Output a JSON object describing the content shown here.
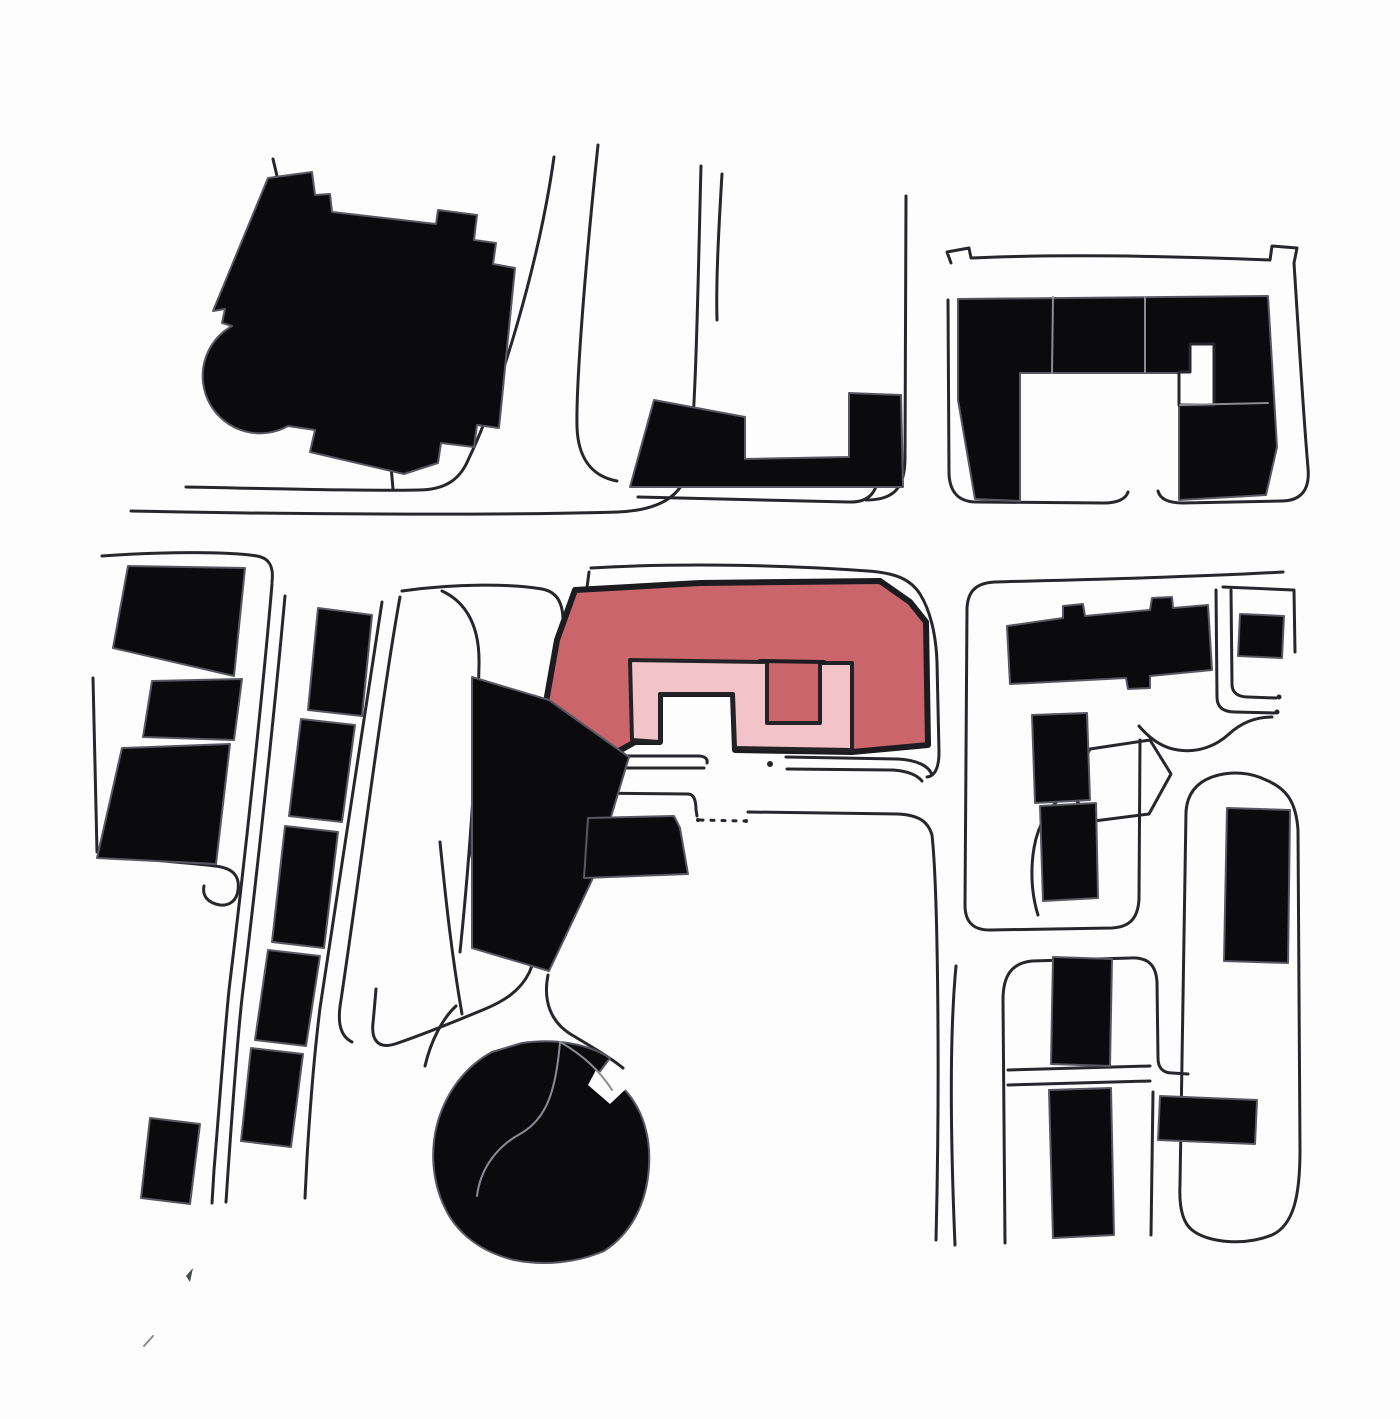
{
  "meta": {
    "description": "Hand-drawn urban figure-ground site plan with black context buildings, sketched street lines and one highlighted U-shaped building filled red with a light pink inner courtyard ring",
    "canvas": {
      "width": 1400,
      "height": 1419,
      "background": "#fdfdfd"
    }
  },
  "colors": {
    "building_fill": "#0b0b0e",
    "building_halo": "#585862",
    "street_line": "#26262c",
    "highlight_red": "#ca656c",
    "highlight_pink": "#f2c3c8",
    "highlight_border": "#1c1c20",
    "faint_line": "#8b8b95",
    "paper": "#fdfdfd"
  },
  "svg": {
    "streets": [
      {
        "name": "street-nw-upper",
        "d": "M 186,487 C 290,489 372,491 418,490 C 447,490 461,478 469,458 C 499,396 539,264 554,157"
      },
      {
        "name": "street-nw-lower",
        "d": "M 131,511 C 320,515 520,515 618,512 C 666,510 684,491 688,468 C 696,428 698,278 701,166"
      },
      {
        "name": "street-center-fork-left",
        "d": "M 598,145 C 585,268 576,384 577,427 C 578,456 590,476 617,481"
      },
      {
        "name": "street-center-fork-right",
        "d": "M 722,174 C 718,240 716,285 717,320"
      },
      {
        "name": "street-center-block-south",
        "d": "M 638,497 L 848,502 C 870,503 879,492 880,464 L 881,433"
      },
      {
        "name": "street-center-block-east",
        "d": "M 906,196 L 905,458 C 905,488 894,500 866,500"
      },
      {
        "name": "street-left-top",
        "d": "M 102,556 C 170,551 232,552 257,556 C 269,558 274,566 272,582"
      },
      {
        "name": "street-left-a",
        "d": "M 272,584 C 263,690 246,850 229,990 C 224,1040 219,1110 214,1170 L 212,1203"
      },
      {
        "name": "street-left-b",
        "d": "M 285,596 C 276,696 259,858 242,998 C 237,1044 232,1114 228,1172 L 226,1202"
      },
      {
        "name": "street-strip-east",
        "d": "M 382,602 C 366,700 340,880 320,1008 C 315,1048 310,1108 307,1158 L 305,1198"
      },
      {
        "name": "street-park-west",
        "d": "M 400,597 C 383,690 359,880 341,1000 C 337,1022 340,1036 352,1042"
      },
      {
        "name": "park-outline",
        "d": "M 402,591 C 458,583 512,584 542,589 C 558,592 564,604 563,627 C 561,690 551,810 546,872 C 542,920 537,956 529,973 C 520,991 504,1001 485,1009 C 449,1024 413,1038 395,1044 C 379,1049 371,1041 373,1023 C 374,1013 375,1001 376,989"
      },
      {
        "name": "park-inner-path",
        "d": "M 442,591 C 466,602 480,626 479,665 C 477,765 467,885 460,952"
      },
      {
        "name": "street-hook-end",
        "d": "M 112,856 C 150,860 190,863 215,866 C 233,868 240,876 238,890 C 237,900 230,906 220,905 C 208,903 202,896 204,886"
      },
      {
        "name": "street-left-edge",
        "d": "M 93,678 L 97,852"
      },
      {
        "name": "site-block-outline-north",
        "d": "M 591,568 C 690,562 800,566 868,571 C 897,573 911,580 920,594 C 930,610 936,634 937,662 L 939,752 C 939,768 935,776 927,777"
      },
      {
        "name": "site-block-outline-west",
        "d": "M 589,572 C 583,615 581,655 584,696"
      },
      {
        "name": "street-site-south-1a",
        "d": "M 612,756 L 698,756 C 705,756 708,759 707,763"
      },
      {
        "name": "street-site-south-1b",
        "d": "M 607,768 L 704,768"
      },
      {
        "name": "street-site-south-2a",
        "d": "M 786,757 L 898,759 C 917,760 929,766 932,775"
      },
      {
        "name": "street-site-south-2b",
        "d": "M 787,769 L 893,770 C 907,771 917,775 922,781"
      },
      {
        "name": "street-lower-block-edge",
        "d": "M 586,793 L 688,794 C 694,794 696,800 696,810 L 697,816"
      },
      {
        "name": "street-mid-east",
        "d": "M 748,812 L 898,814 C 918,815 928,821 932,835 C 938,890 940,1080 936,1240"
      },
      {
        "name": "street-mid-east-2",
        "d": "M 956,966 C 949,1040 951,1150 955,1245"
      },
      {
        "name": "street-sw-1",
        "d": "M 440,842 C 446,902 452,957 462,1014"
      },
      {
        "name": "street-sw-2",
        "d": "M 470,843 C 476,882 481,914 487,942"
      },
      {
        "name": "street-sw-curve",
        "d": "M 548,975 C 543,1000 550,1022 572,1035 C 592,1047 611,1058 623,1068"
      },
      {
        "name": "street-circle-nw",
        "d": "M 456,1006 C 443,1018 431,1040 425,1066"
      },
      {
        "name": "loop-a-outline",
        "d": "M 1283,572 C 1180,578 1060,580 995,582 C 976,583 968,591 967,608 L 965,905 C 965,922 973,930 990,930 L 1112,928 C 1130,927 1138,918 1139,899 L 1140,740"
      },
      {
        "name": "loop-a-east-1",
        "d": "M 1216,590 L 1217,697 C 1217,708 1224,712 1235,712 L 1275,713"
      },
      {
        "name": "loop-a-east-2",
        "d": "M 1231,590 L 1232,684 C 1232,693 1238,697 1248,697 L 1276,698"
      },
      {
        "name": "street-square-top",
        "d": "M 1223,587 C 1247,588 1270,589 1293,590"
      },
      {
        "name": "street-square-right",
        "d": "M 1294,590 L 1295,652"
      },
      {
        "name": "street-zigzag",
        "d": "M 1139,726 C 1150,739 1163,748 1178,750 C 1198,753 1216,746 1229,734 C 1241,723 1256,717 1272,717"
      },
      {
        "name": "island-outline",
        "d": "M 1068,791 L 1090,749 L 1150,740 L 1171,774 L 1149,814 L 1094,821 Z"
      },
      {
        "name": "island-tail",
        "d": "M 1068,793 C 1050,804 1038,824 1034,848 C 1030,872 1032,896 1038,915"
      },
      {
        "name": "loop-b-outline",
        "d": "M 1266,780 C 1285,788 1296,800 1298,830 L 1300,1150 C 1300,1195 1294,1225 1272,1235 C 1245,1246 1208,1243 1192,1230 C 1182,1222 1179,1206 1180,1185 L 1186,812 C 1187,794 1196,783 1212,777 C 1232,770 1252,773 1266,780"
      },
      {
        "name": "loop-c-outline",
        "d": "M 1005,1243 L 1003,1000 C 1003,975 1012,963 1032,961 L 1130,958 C 1148,957 1156,965 1157,982 L 1158,1058 C 1158,1068 1163,1073 1172,1073 L 1188,1074"
      },
      {
        "name": "loop-c-east-lower",
        "d": "M 1153,1092 L 1151,1235"
      },
      {
        "name": "loop-c-cross-1",
        "d": "M 1008,1070 L 1150,1066"
      },
      {
        "name": "loop-c-cross-2",
        "d": "M 1008,1085 L 1150,1081"
      },
      {
        "name": "ne-block-outline-1",
        "d": "M 951,263 L 947,252 L 969,248 L 971,258 C 1060,254 1170,256 1270,260 L 1272,246 L 1297,248 L 1294,263 C 1299,340 1303,410 1308,468 C 1310,490 1301,501 1281,501 L 1183,503 C 1168,503 1160,499 1158,491"
      },
      {
        "name": "ne-block-outline-2",
        "d": "M 1128,492 C 1126,499 1117,503 1104,503 L 977,502 C 959,502 950,493 949,474 L 948,300"
      },
      {
        "name": "nw-tick",
        "d": "M 277,176 L 273,159"
      },
      {
        "name": "nw-connector",
        "d": "M 391,466 L 393,489"
      }
    ],
    "highlight": {
      "outer_name": "highlighted-building-red",
      "outer_d": "M 575,590 L 700,583 L 880,581 L 910,602 L 926,622 L 928,745 L 852,752 L 735,750 L 733,694 L 660,694 L 660,742 L 635,742 L 610,756 L 546,702 L 557,640 Z",
      "inner_name": "highlighted-courtyard-pink",
      "inner_d": "M 630,660 L 767,662 L 767,723 L 820,723 L 820,663 L 852,663 L 852,750 L 735,748 L 733,694 L 660,694 L 660,742 L 632,740 Z",
      "seam_name": "highlight-inner-seam",
      "seam_d": "M 760,661 L 824,662"
    },
    "buildings": [
      {
        "name": "building-nw-large",
        "d": "M 268,178 L 312,172 L 315,195 L 330,194 L 332,212 L 436,224 L 438,210 L 477,215 L 474,240 L 496,243 L 493,264 L 515,268 L 499,428 L 477,425 L 474,447 L 441,443 L 438,463 L 404,474 L 310,452 L 315,430 L 288,426 A 55 55 0 1 1 232,326 L 222,323 L 225,309 L 213,311 Z"
      },
      {
        "name": "building-center-l",
        "d": "M 630,487 L 654,400 L 745,417 L 745,459 L 849,457 L 849,393 L 901,395 L 903,487 Z"
      },
      {
        "name": "building-ne-perimeter",
        "d": "M 958,299 L 1268,296 L 1277,447 L 1266,495 L 1179,500 L 1179,373 L 1020,373 L 1020,501 L 975,499 L 958,400 Z"
      },
      {
        "name": "building-sw-diagonal",
        "d": "M 472,677 L 549,700 L 629,757 L 592,880 L 549,971 L 472,948 Z"
      },
      {
        "name": "building-below-site",
        "d": "M 588,818 L 674,816 L 680,828 L 688,874 L 584,878 Z"
      },
      {
        "name": "building-strip-1",
        "d": "M 318,608 L 372,615 L 362,716 L 308,710 Z"
      },
      {
        "name": "building-strip-2",
        "d": "M 301,719 L 355,725 L 342,822 L 289,816 Z"
      },
      {
        "name": "building-strip-3",
        "d": "M 285,826 L 338,832 L 324,948 L 272,942 Z"
      },
      {
        "name": "building-strip-4",
        "d": "M 268,950 L 320,956 L 306,1046 L 255,1040 Z"
      },
      {
        "name": "building-strip-5",
        "d": "M 251,1048 L 303,1054 L 291,1147 L 241,1141 Z"
      },
      {
        "name": "building-strip-6",
        "d": "M 150,1118 L 200,1124 L 190,1204 L 141,1198 Z"
      },
      {
        "name": "building-west-1",
        "d": "M 128,566 L 245,568 L 234,676 L 113,648 Z"
      },
      {
        "name": "building-west-2",
        "d": "M 152,681 L 242,679 L 234,740 L 143,737 Z"
      },
      {
        "name": "building-west-3",
        "d": "M 122,748 L 230,744 L 216,864 L 97,858 Z"
      },
      {
        "name": "building-round",
        "d": "M 522,1043 C 556,1038 588,1044 610,1058 L 598,1074 L 624,1089 C 642,1108 651,1136 649,1166 C 647,1203 631,1234 604,1251 C 576,1263 544,1266 514,1260 C 481,1252 456,1233 444,1206 C 432,1180 430,1149 438,1121 C 447,1091 466,1066 492,1052 Z"
      },
      {
        "name": "building-loopa-slab",
        "d": "M 1007,626 L 1063,618 L 1063,606 L 1083,604 L 1085,616 L 1150,610 L 1152,598 L 1172,597 L 1173,608 L 1208,605 L 1212,670 L 1150,676 L 1150,688 L 1128,689 L 1126,678 L 1010,684 Z"
      },
      {
        "name": "building-loopa-col-1",
        "d": "M 1032,715 L 1087,713 L 1090,800 L 1035,803 Z"
      },
      {
        "name": "building-loopa-col-2",
        "d": "M 1040,806 L 1096,803 L 1098,898 L 1043,901 Z"
      },
      {
        "name": "building-loopb-slab",
        "d": "M 1227,808 L 1290,810 L 1288,963 L 1224,961 Z"
      },
      {
        "name": "building-ne-square",
        "d": "M 1240,614 L 1284,616 L 1282,658 L 1238,656 Z"
      },
      {
        "name": "building-se-col-1",
        "d": "M 1053,957 L 1112,959 L 1110,1066 L 1051,1064 Z"
      },
      {
        "name": "building-se-col-2",
        "d": "M 1049,1090 L 1111,1088 L 1114,1235 L 1053,1238 Z"
      },
      {
        "name": "building-se-slab",
        "d": "M 1160,1096 L 1257,1100 L 1255,1144 L 1158,1140 Z"
      }
    ],
    "white_overlays": [
      {
        "name": "ne-block-notch",
        "d": "M 1190,344 L 1214,344 L 1214,405 L 1179,405 L 1179,372 L 1190,372 Z",
        "stroke": true
      },
      {
        "name": "round-building-notch",
        "d": "M 596,1070 L 628,1087 L 610,1104 L 588,1085 Z",
        "stroke": false
      }
    ],
    "faint_lines": [
      {
        "name": "ne-block-division-1",
        "d": "M 1053,297 L 1052,373"
      },
      {
        "name": "ne-block-division-2",
        "d": "M 1145,297 L 1145,372"
      },
      {
        "name": "ne-block-division-3",
        "d": "M 1180,405 L 1268,403"
      },
      {
        "name": "round-building-inner-1",
        "d": "M 560,1042 C 556,1090 547,1119 520,1134 C 496,1147 480,1170 477,1196"
      },
      {
        "name": "round-building-inner-2",
        "d": "M 560,1042 C 583,1055 600,1071 612,1090"
      },
      {
        "name": "sw-faint-tick",
        "d": "M 144,1346 L 153,1336"
      }
    ],
    "dashed_lines": [
      {
        "name": "dotted-street-link",
        "d": "M 700,820 L 744,821"
      }
    ],
    "dots": [
      {
        "name": "street-dot-1",
        "x": 770,
        "y": 764,
        "r": 3
      },
      {
        "name": "street-dot-2",
        "x": 1277,
        "y": 712,
        "r": 2.5
      },
      {
        "name": "street-dot-3",
        "x": 1279,
        "y": 697,
        "r": 2.5
      },
      {
        "name": "street-dot-4",
        "x": 698,
        "y": 820,
        "r": 2
      },
      {
        "name": "street-dot-5",
        "x": 746,
        "y": 821,
        "r": 2
      }
    ],
    "specks": [
      {
        "name": "paper-speck",
        "d": "M 186,1276 L 193,1268 L 190,1282 Z",
        "fill": "#3c5148"
      }
    ]
  }
}
